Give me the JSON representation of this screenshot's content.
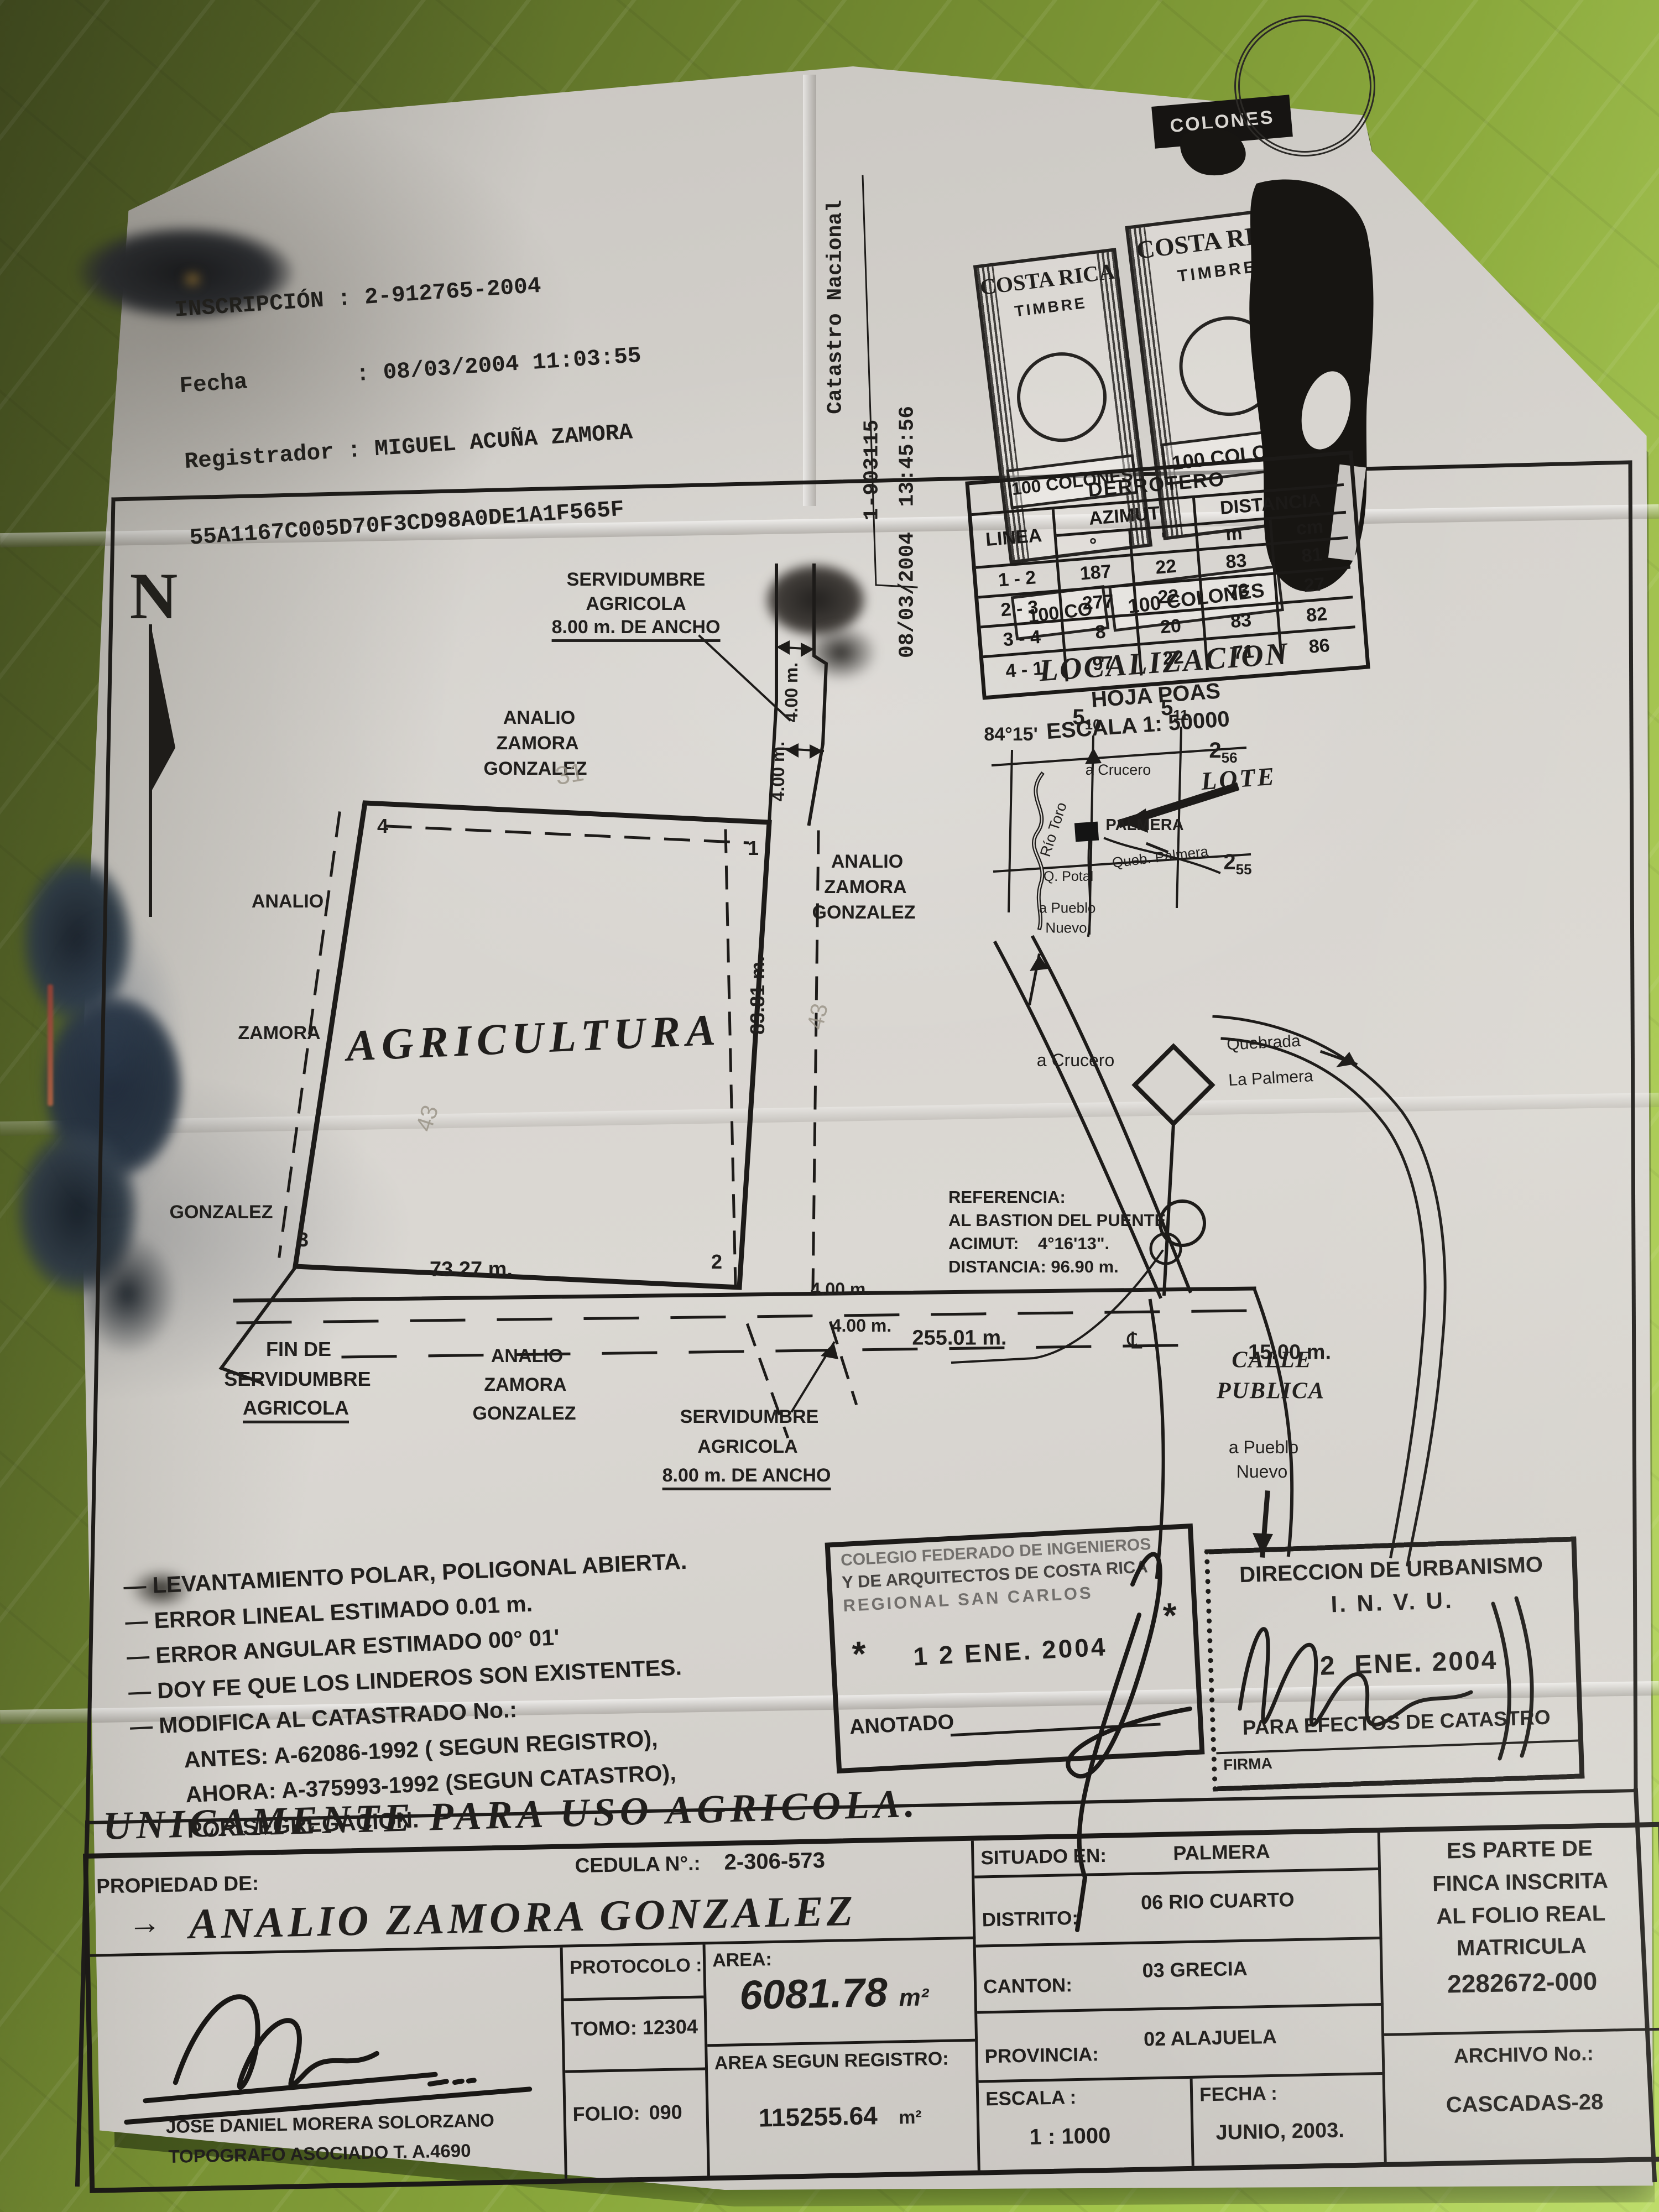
{
  "registry": {
    "line1": "INSCRIPCIÓN : 2-912765-2004",
    "line2": "Fecha        : 08/03/2004 11:03:55",
    "line3": "Registrador : MIGUEL ACUÑA ZAMORA",
    "hash": "55A1167C005D70F3CD98A0DE1A1F565F"
  },
  "margin": {
    "office": "Catastro Nacional",
    "number": "1-903115",
    "datetime": "08/03/2004  13:45:56"
  },
  "stamps": {
    "country": "COSTA RICA",
    "timbre": "TIMBRE",
    "value": "100 COLONES",
    "value_short": "100 CO",
    "colones_band": "COLONES"
  },
  "derrotero": {
    "title": "DERROTERO",
    "linea": "LINEA",
    "azimut": "AZIMUT",
    "distancia": "DISTANCIA",
    "deg": "°",
    "min": "'",
    "m": "m",
    "cm": "cm",
    "rows": [
      [
        "1 - 2",
        "187",
        "22",
        "83",
        "81"
      ],
      [
        "2 - 3",
        "277",
        "22",
        "73",
        "27"
      ],
      [
        "3 - 4",
        "8",
        "20",
        "83",
        "82"
      ],
      [
        "4 - 1",
        "97",
        "22",
        "71",
        "86"
      ]
    ]
  },
  "localizacion": {
    "title": "LOCALIZACION",
    "hoja": "HOJA POAS",
    "escala": "ESCALA 1: 50000",
    "deg84": "84°15'",
    "g5a": "5",
    "g10": "10",
    "g5b": "5",
    "g11": "11",
    "g2a": "2",
    "g56": "56",
    "g2b": "2",
    "g55": "55",
    "lote": "LOTE",
    "crucero": "a Crucero",
    "palmera": "PALMERA",
    "queb": "Queb. Palmera",
    "rio": "Río Toro",
    "potal": "Q. Potal",
    "pueblo1": "a Pueblo",
    "pueblo2": "Nuevo"
  },
  "plot": {
    "north": "N",
    "serv1": "SERVIDUMBRE",
    "serv2": "AGRICOLA",
    "serv3": "8.00 m. DE ANCHO",
    "analio": "ANALIO",
    "zamora": "ZAMORA",
    "gonzalez": "GONZALEZ",
    "agricultura": "AGRICULTURA",
    "len83": "83.81 m.",
    "len73": "73.27 m.",
    "fin1": "FIN DE",
    "fin2": "SERVIDUMBRE",
    "fin3": "AGRICOLA",
    "calle1": "CALLE",
    "calle2": "PUBLICA",
    "pueblo1": "a Pueblo",
    "pueblo2": "Nuevo",
    "crucero": "a Crucero",
    "quebrada1": "Quebrada",
    "quebrada2": "La Palmera",
    "ref1": "REFERENCIA:",
    "ref2": "AL BASTION DEL PUENTE",
    "ref3": "ACIMUT:    4°16'13\".",
    "ref4": "DISTANCIA: 96.90 m.",
    "dim400": "4.00 m.",
    "dim255": "255.01 m.",
    "dim15": "15.00 m.",
    "centerline": "℄",
    "p1": "1",
    "p2": "2",
    "p3": "3",
    "p4": "4",
    "pencil31": "31",
    "pencil43": "43"
  },
  "notes": [
    "— LEVANTAMIENTO POLAR, POLIGONAL ABIERTA.",
    "— ERROR LINEAL ESTIMADO 0.01 m.",
    "— ERROR ANGULAR ESTIMADO 00° 01'",
    "— DOY FE QUE LOS LINDEROS SON EXISTENTES.",
    "— MODIFICA AL CATASTRADO No.:",
    "ANTES: A-62086-1992 ( SEGUN REGISTRO),",
    "AHORA: A-375993-1992 (SEGUN CATASTRO),",
    "POR SEGREGACION."
  ],
  "cfia": {
    "line1": "COLEGIO FEDERADO DE INGENIEROS",
    "line2": "Y DE ARQUITECTOS DE COSTA RICA",
    "line3": "REGIONAL SAN CARLOS",
    "star": "*",
    "date": "1 2 ENE. 2004",
    "anotado": "ANOTADO"
  },
  "invu": {
    "line1": "DIRECCION DE URBANISMO",
    "line2": "I. N. V. U.",
    "date": "2  ENE. 2004",
    "line3": "PARA EFECTOS DE CATASTRO",
    "firma": "FIRMA"
  },
  "titleblock": {
    "uso": "UNICAMENTE PARA USO AGRICOLA.",
    "propiedad_label": "PROPIEDAD DE:",
    "owner_arrow": "→",
    "owner": "ANALIO ZAMORA GONZALEZ",
    "cedula_label": "CEDULA N°.:",
    "cedula": "2-306-573",
    "situado_label": "SITUADO EN:",
    "situado": "PALMERA",
    "distrito_label": "DISTRITO:",
    "distrito": "06 RIO CUARTO",
    "canton_label": "CANTON:",
    "canton": "03 GRECIA",
    "provincia_label": "PROVINCIA:",
    "provincia": "02 ALAJUELA",
    "parte1": "ES PARTE DE",
    "parte2": "FINCA INSCRITA",
    "parte3": "AL FOLIO REAL",
    "parte4": "MATRICULA",
    "matricula": "2282672-000",
    "protocolo_label": "PROTOCOLO :",
    "tomo": "TOMO: 12304",
    "folio_label": "FOLIO:",
    "folio": "090",
    "area_label": "AREA:",
    "area": "6081.78",
    "unit": "m²",
    "area_reg_label": "AREA SEGUN REGISTRO:",
    "area_reg": "115255.64",
    "escala_label": "ESCALA :",
    "escala": "1 : 1000",
    "fecha_label": "FECHA :",
    "fecha": "JUNIO, 2003.",
    "archivo_label": "ARCHIVO No.:",
    "archivo": "CASCADAS-28",
    "surveyor1": "JOSE DANIEL MORERA SOLORZANO",
    "surveyor2": "TOPOGRAFO ASOCIADO T. A.4690"
  }
}
